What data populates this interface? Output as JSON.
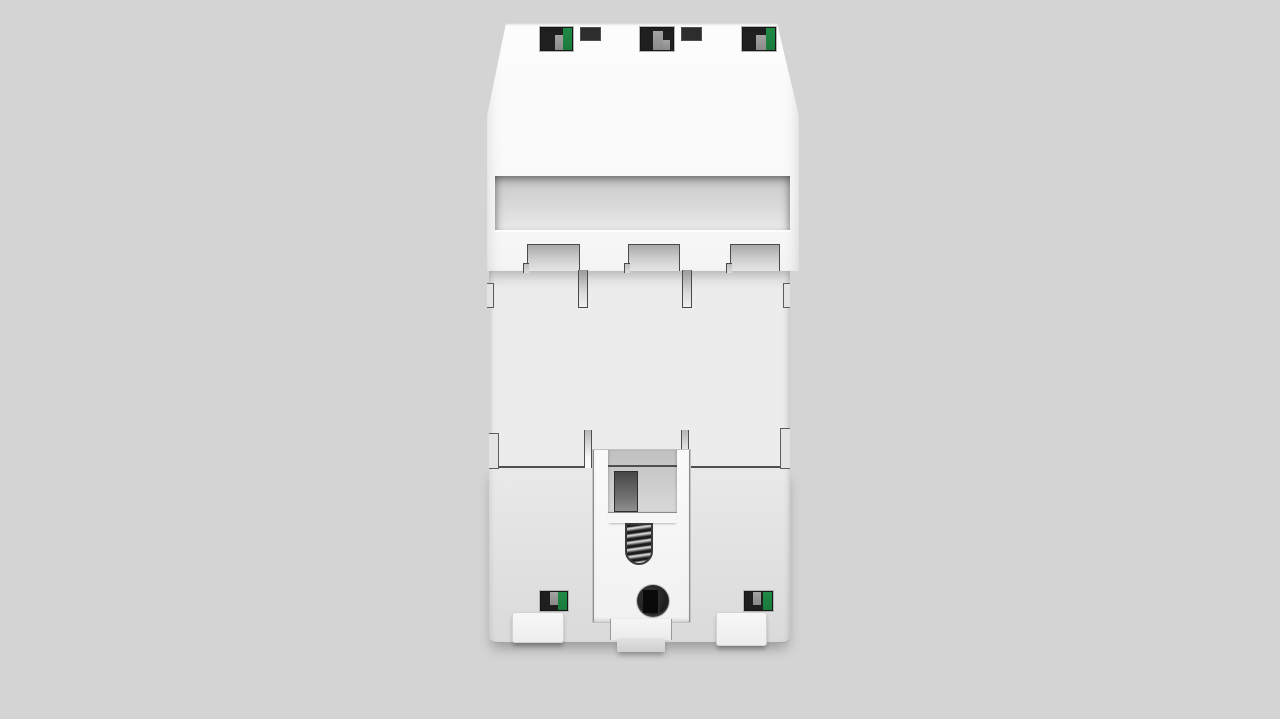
{
  "scene": {
    "description": "3D product render: rear view of a white three-pole DIN-rail mounted electrical module (circuit breaker / surge protection device) on a plain gray background",
    "view": "back side",
    "text_content": "none visible"
  },
  "colors": {
    "background": "#d4d4d4",
    "body_white": "#fcfcfc",
    "body_shade": "#ececec",
    "clip_white": "#fafafa",
    "terminal_black": "#1f1f1f",
    "terminal_green": "#1a7a3c",
    "terminal_gray": "#8f8f8f",
    "outline_dark": "#4a4a4a"
  },
  "parts": {
    "upper_housing": "white front flange with chamfered top corners",
    "panel_recess": "recessed blank label panel",
    "top_terminals": [
      "terminal window with green indicator",
      "terminal window plain",
      "terminal window with green indicator"
    ],
    "vent_slots": 2,
    "pole_divider_tabs": 3,
    "din_rail_clip": "sliding clip with spring, release hole and foot tab",
    "bottom_terminals": [
      "terminal window with green indicator",
      "terminal window with green indicator"
    ],
    "mounting_feet": 2
  }
}
